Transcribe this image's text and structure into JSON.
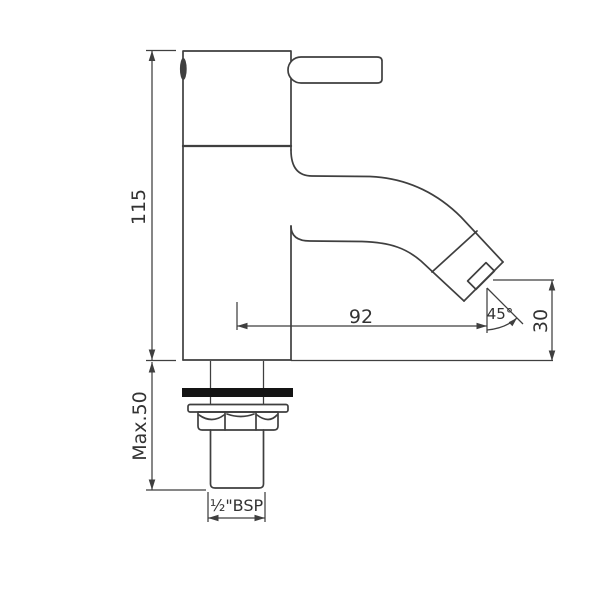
{
  "drawing": {
    "type": "technical-dimension-drawing",
    "subject": "single-lever pillar basin tap, side elevation with mounting shank"
  },
  "drawing_labels": {
    "height": "115",
    "max_deck": "Max.50",
    "reach": "92",
    "angle": "45°",
    "outlet_height": "30",
    "thread": "½\"BSP"
  },
  "colors": {
    "line": "#3f3f3f",
    "text": "#333333",
    "gasket": "#141414",
    "background": "#ffffff"
  }
}
